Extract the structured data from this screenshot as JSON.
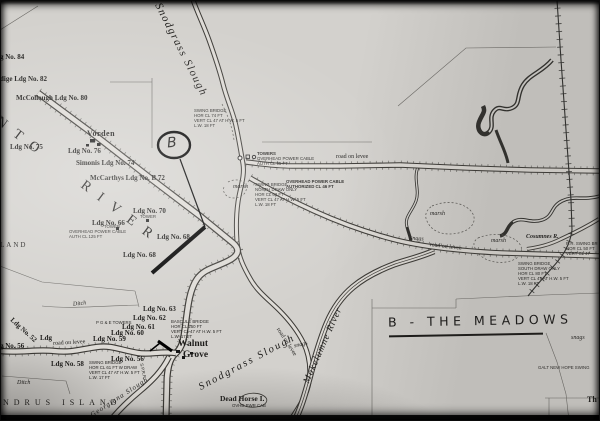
{
  "photo": {
    "caption": "B - THE MEADOWS",
    "circle_mark": "B"
  },
  "waterways": {
    "snodgrass_upper": "Snodgrass Slough",
    "sacramento_partial": "NTO RIVER",
    "snodgrass_lower": "Snodgrass Slough",
    "mokelumne": "Mokelumne River",
    "georgiana": "Georgiana Slough",
    "cosumnes": "Cosumnes R.",
    "dead_horse_island": "Dead Horse I.",
    "dead_horse_cable": "OVHD PWR CAB",
    "andrus_island_partial": "NDRUS ISLAND",
    "island_partial": "LAND"
  },
  "places": {
    "vorden": "Vorden",
    "walnut_grove_line1": "Walnut",
    "walnut_grove_line2": "Grove",
    "corner_partial": "Th",
    "railroad": "S.P.R.R."
  },
  "landings": {
    "no84_partial": "g No. 84",
    "no82_partial": "dige Ldg No. 82",
    "mccollough_80": "McCollough Ldg No. 80",
    "no75": "Ldg No. 75",
    "no76": "Ldg No. 76",
    "simonis_74": "Simonis Ldg No. 74",
    "mccarthys_72": "McCarthys Ldg No. B 72",
    "no70": "Ldg No. 70",
    "no66": "Ldg No. 66",
    "no68_east": "Ldg No. 68",
    "no68_south": "Ldg No. 68",
    "no63": "Ldg No. 63",
    "no62": "Ldg No. 62",
    "no61": "Ldg No. 61",
    "no60": "Ldg No. 60",
    "no59": "Ldg No. 59",
    "no58": "Ldg No. 58",
    "no56": "Ldg No. 56",
    "no56_partial": "g No. 56",
    "no52": "Ldg No. 52",
    "ldg_partial": "Ldg"
  },
  "infrastructure": {
    "tower": "TOWER",
    "towers_junction": "TOWERS",
    "pge_towers": "P G & E TOWERS",
    "cable_125": [
      "OVERHEAD POWER CABLE",
      "AUTH CL 125 FT"
    ],
    "cable_95": [
      "OVERHEAD POWER CABLE",
      "AUTH CL 95 FT"
    ],
    "cable_46": [
      "OVERHEAD POWER CABLE",
      "AUTHORIZED CL 46 FT"
    ],
    "galt_new_hope": "GALT NEW HOPE SWING"
  },
  "bridges": {
    "swing_north": [
      "SWING BRIDGE",
      "HOR CL 74 FT",
      "VERT CL 47 AT H.W. 5 FT",
      "L.W. 18 FT"
    ],
    "swing_center": [
      "SWING BRIDGE",
      "NORTH DRAW ONLY",
      "HOR CL 63 FT",
      "VERT CL 47 AT H.W. 5 FT",
      "L.W. 18 FT"
    ],
    "bascule": [
      "BASCULE BRIDGE",
      "HOR CL 250 FT",
      "VERT CL 47 AT H.W. 5 FT",
      "L.W. 17 FT"
    ],
    "swing_58": [
      "SWING BRIDGE",
      "HOR CL 61 FT W DRAW",
      "VERT CL 47 AT H.W. 5 FT",
      "L.W. 17 FT"
    ],
    "swing_south": [
      "SWING BRIDGE",
      "SOUTH DRAW ONLY",
      "HOR CL 80 FT",
      "VERT CL 47 AT H.W. 5 FT",
      "L.W. 18 FT"
    ],
    "rr_swing": [
      "R.R. SWING BR",
      "HOR CL 50 FT",
      "VERT CL 47"
    ]
  },
  "terrain": {
    "road_on_levee": "road on levee",
    "marsh": "marsh",
    "snags": "snags",
    "ditch": "Ditch"
  },
  "colors": {
    "paper": "#d3d1cd",
    "ink": "#1d1c1a",
    "heavy_annotation": "#000000"
  }
}
